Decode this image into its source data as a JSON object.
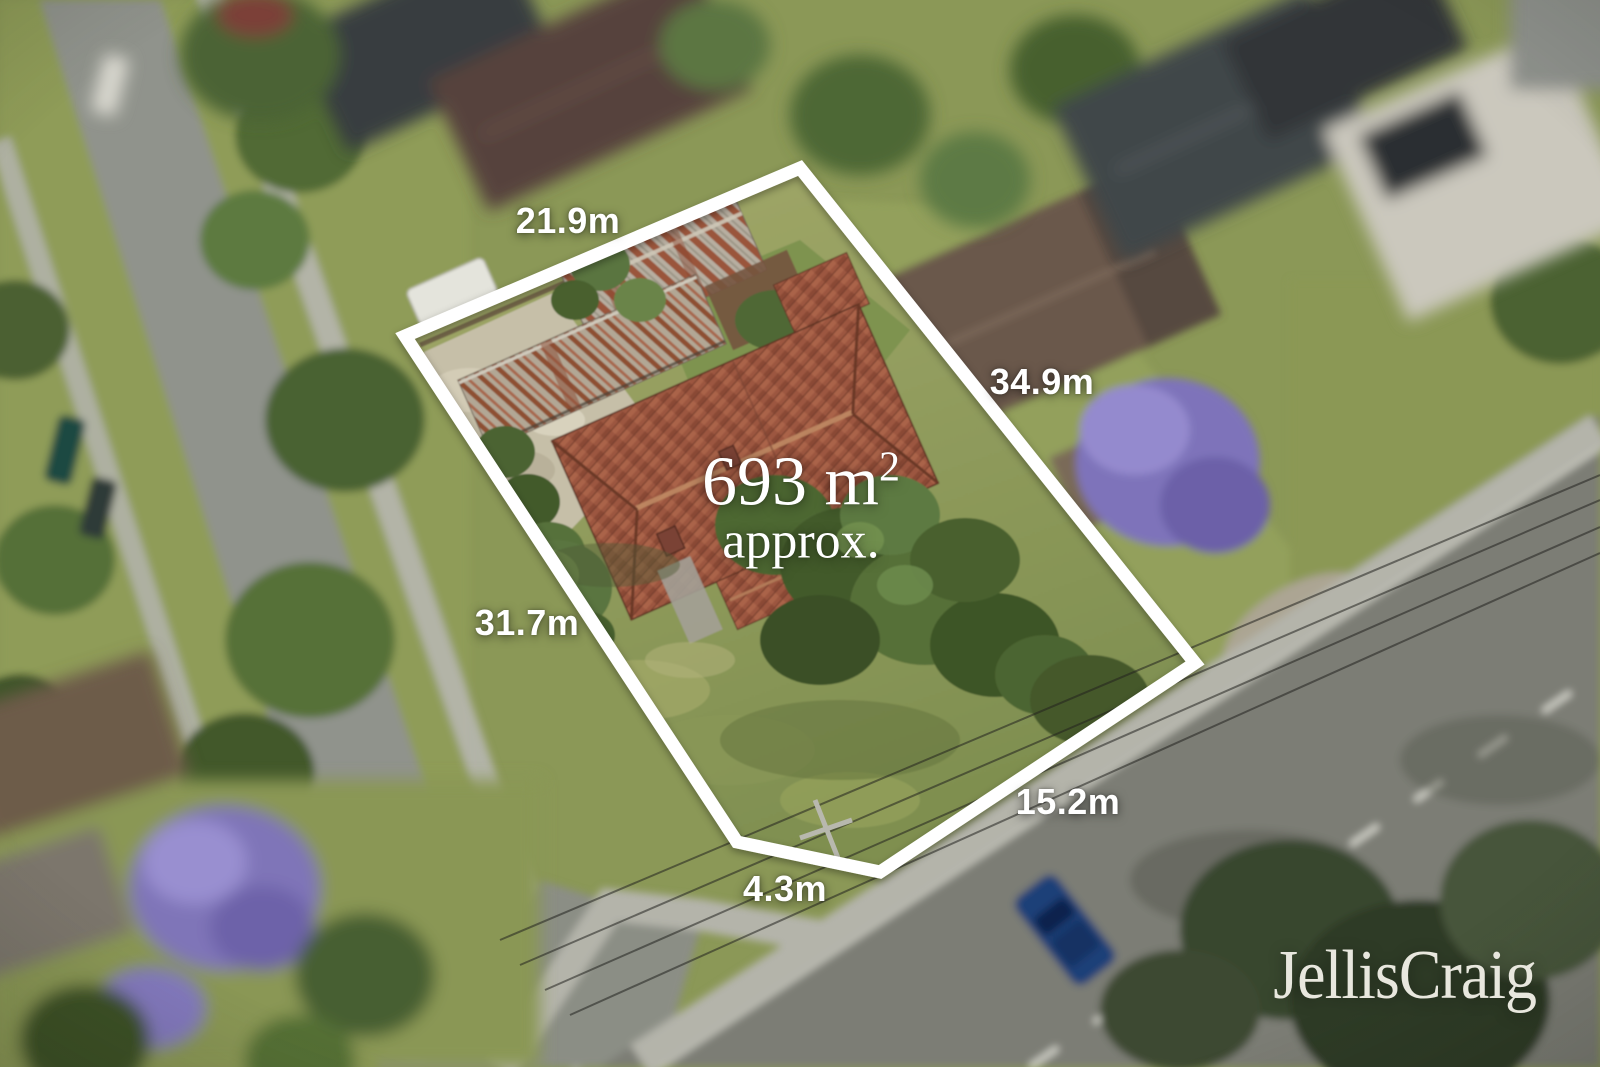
{
  "overlay": {
    "boundary_color": "#ffffff",
    "label_color": "#ffffff",
    "dimensions": {
      "top": "21.9m",
      "right": "34.9m",
      "left": "31.7m",
      "bottom_right": "15.2m",
      "bottom": "4.3m"
    },
    "area": {
      "value": "693 m",
      "superscript": "2",
      "qualifier": "approx."
    }
  },
  "branding": {
    "logo_text": "JellisCraig",
    "logo_color": "#e8e7de"
  }
}
